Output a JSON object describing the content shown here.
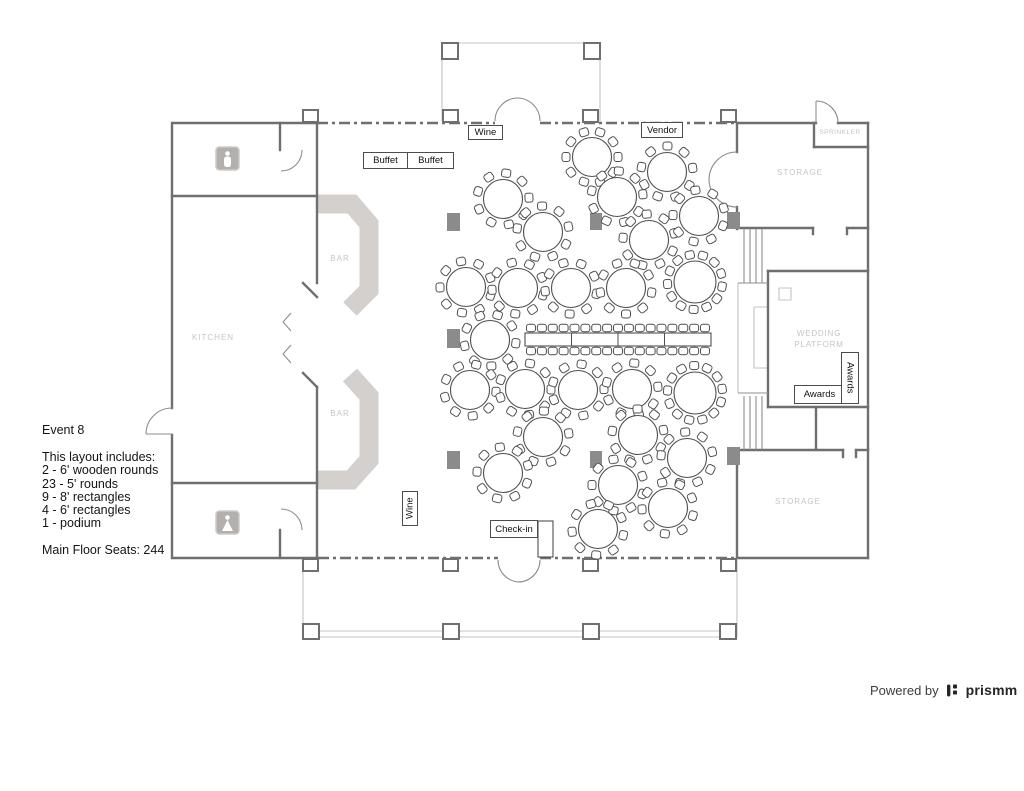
{
  "info_panel": {
    "title": "Event 8",
    "lines": [
      "This layout includes:",
      "2 - 6' wooden rounds",
      "23 - 5' rounds",
      "9 - 8' rectangles",
      "4 - 6' rectangles",
      "1 - podium"
    ],
    "seats": "Main Floor Seats: 244"
  },
  "footer": {
    "powered_by": "Powered by",
    "brand": "prismm"
  },
  "labels": {
    "buffet1": "Buffet",
    "buffet2": "Buffet",
    "wine_top": "Wine",
    "vendor": "Vendor",
    "wine_bottom": "Wine",
    "checkin": "Check-in",
    "awards_h": "Awards",
    "awards_v": "Awards"
  },
  "rooms": {
    "kitchen": "KITCHEN",
    "bar1": "BAR",
    "bar2": "BAR",
    "storage_top": "STORAGE",
    "storage_bottom": "STORAGE",
    "sprinkler": "SPRINKLER",
    "platform": "WEDDING PLATFORM"
  },
  "floorplan": {
    "colors": {
      "wall": "#6f6f6f",
      "wood_table": "#b79564",
      "pillar": "#8b8b8b",
      "bar": "#d3d0cd",
      "room_label": "#c8c5c2"
    },
    "walls": [
      "M172,408 L172,123 L318,123",
      "M172,435 L172,558 L318,558",
      "M172,196 L317,196",
      "M172,483 L317,483",
      "M280,123 L280,150",
      "M280,530 L280,558",
      "M317,123 L317,283",
      "M317,387 L317,558",
      "M303,283 L317,297",
      "M303,373 L317,387",
      "M737,123 L816,123",
      "M838,123 L868,123",
      "M868,123 L868,558",
      "M737,558 L868,558",
      "M737,123 L737,152",
      "M737,207 L737,229",
      "M737,228 L813,228",
      "M847,228 L868,228",
      "M814,123 L814,147",
      "M814,147 L868,147",
      "M768,271 L768,407",
      "M768,271 L868,271",
      "M768,407 L868,407",
      "M816,407 L816,450",
      "M737,450 L843,450",
      "M856,450 L868,450",
      "M737,450 L737,558",
      "M813,228 L813,234",
      "M847,228 L847,234",
      "M843,450 L843,457",
      "M856,450 L856,457"
    ],
    "window_walls": [
      "M317,123 L495,123",
      "M540,123 L737,123",
      "M318,558 L498,558",
      "M540,558 L737,558"
    ],
    "doors_and_stairs": [
      "M495,121 A23,23 0 0 1 518,98",
      "M540,121 A23,23 0 0 0 517,98",
      "M498,560 A22,22 0 0 0 520,582",
      "M540,560 A22,22 0 0 1 518,582",
      "M737,152 A28,28 0 0 0 709,180",
      "M737,207 A28,28 0 0 1 709,179",
      "M816,123 L816,101",
      "M816,101 A22,22 0 0 1 838,123",
      "M172,408 A26,26 0 0 0 146,434",
      "M146,434 L172,434",
      "M302,150 A21,21 0 0 1 281,171",
      "M302,530 A21,21 0 0 0 281,509",
      "M291,313 L283,322 L291,331",
      "M291,345 L283,354 L291,363",
      "M744,229 L744,283",
      "M750,229 L750,283",
      "M756,229 L756,283",
      "M762,229 L762,283",
      "M738,283 L768,283",
      "M744,396 L744,450",
      "M750,396 L750,450",
      "M756,396 L756,450",
      "M762,396 L762,450",
      "M738,393 L768,393"
    ],
    "porch_lines": [
      "M442,121 L442,43 L600,43 L600,121",
      "M303,560 L303,637 L737,637 L737,560",
      "M303,631 L737,631",
      "M754,307 L768,307 L768,368 L754,368 L754,307",
      "M779,288 L791,288 L791,300 L779,300 L779,288",
      "M738,283 L738,393"
    ],
    "posts": [
      [
        442,
        43,
        16,
        16
      ],
      [
        584,
        43,
        16,
        16
      ],
      [
        303,
        110,
        15,
        12
      ],
      [
        443,
        110,
        15,
        12
      ],
      [
        583,
        110,
        15,
        12
      ],
      [
        721,
        110,
        15,
        12
      ],
      [
        303,
        559,
        15,
        12
      ],
      [
        443,
        559,
        15,
        12
      ],
      [
        583,
        559,
        15,
        12
      ],
      [
        721,
        559,
        15,
        12
      ],
      [
        303,
        624,
        16,
        15
      ],
      [
        443,
        624,
        16,
        15
      ],
      [
        583,
        624,
        16,
        15
      ],
      [
        720,
        624,
        16,
        15
      ]
    ],
    "pillars": [
      [
        447,
        213,
        13,
        18
      ],
      [
        590,
        213,
        12,
        17
      ],
      [
        727,
        212,
        13,
        17
      ],
      [
        447,
        329,
        13,
        19
      ],
      [
        447,
        451,
        13,
        18
      ],
      [
        590,
        451,
        12,
        17
      ],
      [
        727,
        447,
        13,
        18
      ]
    ],
    "bars": [
      "M317,204 L352,204 L369,224 L369,290 L350,309",
      "M317,480 L351,480 L369,460 L369,396 L350,375"
    ],
    "round_tables": [
      [
        592,
        157,
        10
      ],
      [
        503,
        199,
        9
      ],
      [
        617,
        197,
        9
      ],
      [
        667,
        172,
        9
      ],
      [
        543,
        232,
        9
      ],
      [
        649,
        240,
        9
      ],
      [
        699,
        216,
        9
      ],
      [
        466,
        287,
        9
      ],
      [
        518,
        288,
        9
      ],
      [
        571,
        288,
        9
      ],
      [
        626,
        288,
        9
      ],
      [
        490,
        340,
        9
      ],
      [
        470,
        390,
        9
      ],
      [
        525,
        389,
        9
      ],
      [
        578,
        390,
        9
      ],
      [
        632,
        389,
        9
      ],
      [
        543,
        437,
        9
      ],
      [
        638,
        435,
        9
      ],
      [
        687,
        458,
        9
      ],
      [
        503,
        473,
        9
      ],
      [
        618,
        485,
        9
      ],
      [
        668,
        508,
        9
      ],
      [
        598,
        529,
        9
      ]
    ],
    "wooden_tables": [
      [
        695,
        282,
        13
      ],
      [
        695,
        393,
        13
      ]
    ],
    "long_table": {
      "x": 525,
      "y": 333,
      "w": 186,
      "h": 13,
      "dividers": [
        571.5,
        618,
        664.5
      ],
      "chairs_per_side": 17
    },
    "side_tables": [
      [
        538,
        521,
        15,
        36
      ]
    ],
    "restrooms": [
      {
        "x": 216,
        "y": 147,
        "g": "m"
      },
      {
        "x": 216,
        "y": 511,
        "g": "f"
      }
    ]
  }
}
